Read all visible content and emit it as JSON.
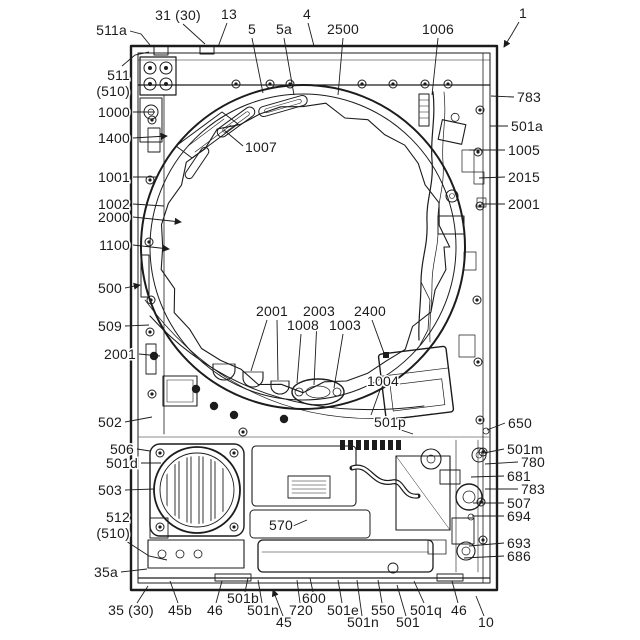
{
  "colors": {
    "ink": "#1c1c1c",
    "paper": "#ffffff"
  },
  "labels": [
    {
      "text": "511a",
      "x": 127,
      "y": 35,
      "anchor": "end",
      "leaders": [
        [
          [
            130,
            31
          ],
          [
            141,
            34
          ],
          [
            150,
            45
          ]
        ]
      ]
    },
    {
      "text": "31 (30)",
      "x": 178,
      "y": 20,
      "anchor": "middle",
      "leaders": [
        [
          [
            183,
            24
          ],
          [
            205,
            44
          ]
        ]
      ]
    },
    {
      "text": "13",
      "x": 229,
      "y": 19,
      "anchor": "middle",
      "leaders": [
        [
          [
            227,
            23
          ],
          [
            218,
            47
          ]
        ]
      ]
    },
    {
      "text": "5",
      "x": 252,
      "y": 34,
      "anchor": "middle",
      "leaders": [
        [
          [
            252,
            38
          ],
          [
            263,
            93
          ]
        ]
      ]
    },
    {
      "text": "5a",
      "x": 284,
      "y": 34,
      "anchor": "middle",
      "leaders": [
        [
          [
            284,
            38
          ],
          [
            294,
            95
          ]
        ]
      ]
    },
    {
      "text": "4",
      "x": 307,
      "y": 19,
      "anchor": "middle",
      "leaders": [
        [
          [
            308,
            23
          ],
          [
            314,
            46
          ]
        ]
      ]
    },
    {
      "text": "2500",
      "x": 343,
      "y": 34,
      "anchor": "middle",
      "leaders": [
        [
          [
            343,
            38
          ],
          [
            338,
            95
          ]
        ]
      ]
    },
    {
      "text": "1006",
      "x": 438,
      "y": 34,
      "anchor": "middle",
      "leaders": [
        [
          [
            438,
            38
          ],
          [
            432,
            95
          ]
        ]
      ]
    },
    {
      "text": "1",
      "x": 523,
      "y": 18,
      "anchor": "middle",
      "arrow": true,
      "leaders": [
        [
          [
            519,
            22
          ],
          [
            512,
            34
          ],
          [
            504,
            47
          ]
        ]
      ]
    },
    {
      "text": "511\n(510)",
      "x": 130,
      "y": 80,
      "anchor": "end",
      "leaders": [
        [
          [
            122,
            66
          ],
          [
            135,
            55
          ],
          [
            149,
            52
          ]
        ]
      ]
    },
    {
      "text": "1000",
      "x": 130,
      "y": 117,
      "anchor": "end",
      "leaders": [
        [
          [
            133,
            112
          ],
          [
            155,
            112
          ]
        ]
      ]
    },
    {
      "text": "1400",
      "x": 130,
      "y": 143,
      "anchor": "end",
      "arrow": true,
      "leaders": [
        [
          [
            133,
            138
          ],
          [
            167,
            136
          ]
        ]
      ]
    },
    {
      "text": "1001",
      "x": 130,
      "y": 182,
      "anchor": "end",
      "leaders": [
        [
          [
            133,
            177
          ],
          [
            157,
            177
          ]
        ]
      ]
    },
    {
      "text": "1002",
      "x": 130,
      "y": 209,
      "anchor": "end",
      "leaders": [
        [
          [
            133,
            204
          ],
          [
            164,
            206
          ]
        ]
      ]
    },
    {
      "text": "2000",
      "x": 130,
      "y": 222,
      "anchor": "end",
      "arrow": true,
      "leaders": [
        [
          [
            133,
            217
          ],
          [
            181,
            222
          ]
        ]
      ]
    },
    {
      "text": "1100",
      "x": 130,
      "y": 250,
      "anchor": "end",
      "arrow": true,
      "leaders": [
        [
          [
            133,
            245
          ],
          [
            169,
            249
          ]
        ]
      ]
    },
    {
      "text": "500",
      "x": 122,
      "y": 293,
      "anchor": "end",
      "arrow": true,
      "leaders": [
        [
          [
            125,
            288
          ],
          [
            140,
            285
          ]
        ]
      ]
    },
    {
      "text": "509",
      "x": 122,
      "y": 331,
      "anchor": "end",
      "leaders": [
        [
          [
            125,
            326
          ],
          [
            149,
            325
          ]
        ]
      ]
    },
    {
      "text": "2001",
      "x": 136,
      "y": 359,
      "anchor": "end",
      "leaders": [
        [
          [
            139,
            354
          ],
          [
            160,
            356
          ]
        ]
      ]
    },
    {
      "text": "502",
      "x": 122,
      "y": 427,
      "anchor": "end",
      "leaders": [
        [
          [
            125,
            422
          ],
          [
            152,
            417
          ]
        ]
      ]
    },
    {
      "text": "506",
      "x": 134,
      "y": 454,
      "anchor": "end",
      "leaders": [
        [
          [
            137,
            449
          ],
          [
            150,
            451
          ]
        ]
      ]
    },
    {
      "text": "501d",
      "x": 138,
      "y": 468,
      "anchor": "end",
      "leaders": [
        [
          [
            141,
            463
          ],
          [
            161,
            463
          ]
        ]
      ]
    },
    {
      "text": "503",
      "x": 122,
      "y": 495,
      "anchor": "end",
      "leaders": [
        [
          [
            125,
            490
          ],
          [
            154,
            489
          ]
        ]
      ]
    },
    {
      "text": "512\n(510)",
      "x": 130,
      "y": 522,
      "anchor": "end",
      "leaders": [
        [
          [
            126,
            541
          ],
          [
            149,
            556
          ],
          [
            167,
            560
          ]
        ]
      ]
    },
    {
      "text": "35a",
      "x": 118,
      "y": 577,
      "anchor": "end",
      "leaders": [
        [
          [
            121,
            572
          ],
          [
            147,
            569
          ]
        ]
      ]
    },
    {
      "text": "35 (30)",
      "x": 131,
      "y": 615,
      "anchor": "middle",
      "leaders": [
        [
          [
            137,
            603
          ],
          [
            148,
            586
          ]
        ]
      ]
    },
    {
      "text": "45b",
      "x": 180,
      "y": 615,
      "anchor": "middle",
      "leaders": [
        [
          [
            178,
            603
          ],
          [
            170,
            581
          ]
        ]
      ]
    },
    {
      "text": "46",
      "x": 215,
      "y": 615,
      "anchor": "middle",
      "leaders": [
        [
          [
            216,
            603
          ],
          [
            222,
            581
          ]
        ]
      ]
    },
    {
      "text": "501b",
      "x": 243,
      "y": 603,
      "anchor": "middle",
      "leaders": [
        [
          [
            245,
            592
          ],
          [
            248,
            578
          ]
        ]
      ]
    },
    {
      "text": "501n",
      "x": 263,
      "y": 615,
      "anchor": "middle",
      "leaders": [
        [
          [
            262,
            603
          ],
          [
            258,
            580
          ]
        ]
      ]
    },
    {
      "text": "45",
      "x": 284,
      "y": 627,
      "anchor": "middle",
      "arrow": true,
      "leaders": [
        [
          [
            283,
            616
          ],
          [
            273,
            590
          ]
        ]
      ]
    },
    {
      "text": "720",
      "x": 301,
      "y": 615,
      "anchor": "middle",
      "leaders": [
        [
          [
            300,
            603
          ],
          [
            297,
            580
          ]
        ]
      ]
    },
    {
      "text": "600",
      "x": 314,
      "y": 603,
      "anchor": "middle",
      "leaders": [
        [
          [
            313,
            592
          ],
          [
            310,
            578
          ]
        ]
      ]
    },
    {
      "text": "501e",
      "x": 343,
      "y": 615,
      "anchor": "middle",
      "leaders": [
        [
          [
            342,
            603
          ],
          [
            338,
            580
          ]
        ]
      ]
    },
    {
      "text": "501n",
      "x": 363,
      "y": 627,
      "anchor": "middle",
      "leaders": [
        [
          [
            362,
            616
          ],
          [
            357,
            580
          ]
        ]
      ]
    },
    {
      "text": "550",
      "x": 383,
      "y": 615,
      "anchor": "middle",
      "leaders": [
        [
          [
            382,
            603
          ],
          [
            378,
            580
          ]
        ]
      ]
    },
    {
      "text": "501",
      "x": 408,
      "y": 627,
      "anchor": "middle",
      "leaders": [
        [
          [
            406,
            616
          ],
          [
            397,
            585
          ]
        ]
      ]
    },
    {
      "text": "501q",
      "x": 426,
      "y": 615,
      "anchor": "middle",
      "leaders": [
        [
          [
            424,
            603
          ],
          [
            414,
            581
          ]
        ]
      ]
    },
    {
      "text": "46",
      "x": 459,
      "y": 615,
      "anchor": "middle",
      "leaders": [
        [
          [
            458,
            603
          ],
          [
            452,
            581
          ]
        ]
      ]
    },
    {
      "text": "10",
      "x": 486,
      "y": 627,
      "anchor": "middle",
      "leaders": [
        [
          [
            484,
            616
          ],
          [
            476,
            596
          ]
        ]
      ]
    },
    {
      "text": "783",
      "x": 517,
      "y": 102,
      "anchor": "start",
      "leaders": [
        [
          [
            514,
            97
          ],
          [
            491,
            96
          ]
        ]
      ]
    },
    {
      "text": "501a",
      "x": 511,
      "y": 131,
      "anchor": "start",
      "leaders": [
        [
          [
            508,
            126
          ],
          [
            490,
            126
          ]
        ]
      ]
    },
    {
      "text": "1005",
      "x": 508,
      "y": 155,
      "anchor": "start",
      "leaders": [
        [
          [
            505,
            150
          ],
          [
            469,
            150
          ]
        ]
      ]
    },
    {
      "text": "2015",
      "x": 508,
      "y": 182,
      "anchor": "start",
      "leaders": [
        [
          [
            505,
            177
          ],
          [
            479,
            178
          ]
        ]
      ]
    },
    {
      "text": "2001",
      "x": 508,
      "y": 209,
      "anchor": "start",
      "leaders": [
        [
          [
            505,
            204
          ],
          [
            481,
            204
          ]
        ]
      ]
    },
    {
      "text": "650",
      "x": 508,
      "y": 428,
      "anchor": "start",
      "leaders": [
        [
          [
            505,
            423
          ],
          [
            487,
            430
          ]
        ]
      ]
    },
    {
      "text": "501m",
      "x": 507,
      "y": 454,
      "anchor": "start",
      "leaders": [
        [
          [
            504,
            449
          ],
          [
            484,
            453
          ]
        ]
      ]
    },
    {
      "text": "780",
      "x": 521,
      "y": 467,
      "anchor": "start",
      "leaders": [
        [
          [
            518,
            462
          ],
          [
            485,
            464
          ]
        ]
      ]
    },
    {
      "text": "681",
      "x": 507,
      "y": 481,
      "anchor": "start",
      "leaders": [
        [
          [
            504,
            476
          ],
          [
            471,
            477
          ]
        ]
      ]
    },
    {
      "text": "783",
      "x": 521,
      "y": 494,
      "anchor": "start",
      "leaders": [
        [
          [
            518,
            489
          ],
          [
            485,
            489
          ]
        ]
      ]
    },
    {
      "text": "507",
      "x": 507,
      "y": 508,
      "anchor": "start",
      "leaders": [
        [
          [
            504,
            503
          ],
          [
            473,
            503
          ]
        ]
      ]
    },
    {
      "text": "694",
      "x": 507,
      "y": 521,
      "anchor": "start",
      "leaders": [
        [
          [
            504,
            516
          ],
          [
            472,
            516
          ]
        ]
      ]
    },
    {
      "text": "693",
      "x": 507,
      "y": 548,
      "anchor": "start",
      "leaders": [
        [
          [
            504,
            543
          ],
          [
            469,
            546
          ]
        ]
      ]
    },
    {
      "text": "686",
      "x": 507,
      "y": 561,
      "anchor": "start",
      "leaders": [
        [
          [
            504,
            556
          ],
          [
            464,
            558
          ]
        ]
      ]
    },
    {
      "text": "1007",
      "x": 245,
      "y": 152,
      "anchor": "start",
      "leaders": [
        [
          [
            243,
            146
          ],
          [
            224,
            130
          ]
        ]
      ]
    },
    {
      "text": "2001",
      "x": 272,
      "y": 316,
      "anchor": "middle",
      "leaders": [
        [
          [
            267,
            320
          ],
          [
            251,
            371
          ]
        ],
        [
          [
            277,
            320
          ],
          [
            278,
            380
          ]
        ]
      ]
    },
    {
      "text": "2003",
      "x": 319,
      "y": 316,
      "anchor": "middle",
      "leaders": [
        [
          [
            317,
            320
          ],
          [
            314,
            385
          ]
        ]
      ]
    },
    {
      "text": "1008",
      "x": 303,
      "y": 330,
      "anchor": "middle",
      "leaders": [
        [
          [
            301,
            334
          ],
          [
            297,
            383
          ]
        ]
      ]
    },
    {
      "text": "1003",
      "x": 345,
      "y": 330,
      "anchor": "middle",
      "leaders": [
        [
          [
            343,
            334
          ],
          [
            334,
            388
          ]
        ]
      ]
    },
    {
      "text": "2400",
      "x": 370,
      "y": 316,
      "anchor": "middle",
      "leaders": [
        [
          [
            372,
            320
          ],
          [
            384,
            353
          ]
        ]
      ]
    },
    {
      "text": "1004",
      "x": 383,
      "y": 386,
      "anchor": "middle",
      "leaders": [
        [
          [
            380,
            390
          ],
          [
            371,
            415
          ]
        ]
      ]
    },
    {
      "text": "501p",
      "x": 390,
      "y": 427,
      "anchor": "middle",
      "leaders": [
        [
          [
            401,
            430
          ],
          [
            413,
            434
          ]
        ]
      ]
    },
    {
      "text": "570",
      "x": 281,
      "y": 530,
      "anchor": "middle",
      "leaders": [
        [
          [
            293,
            526
          ],
          [
            307,
            520
          ]
        ]
      ]
    }
  ]
}
